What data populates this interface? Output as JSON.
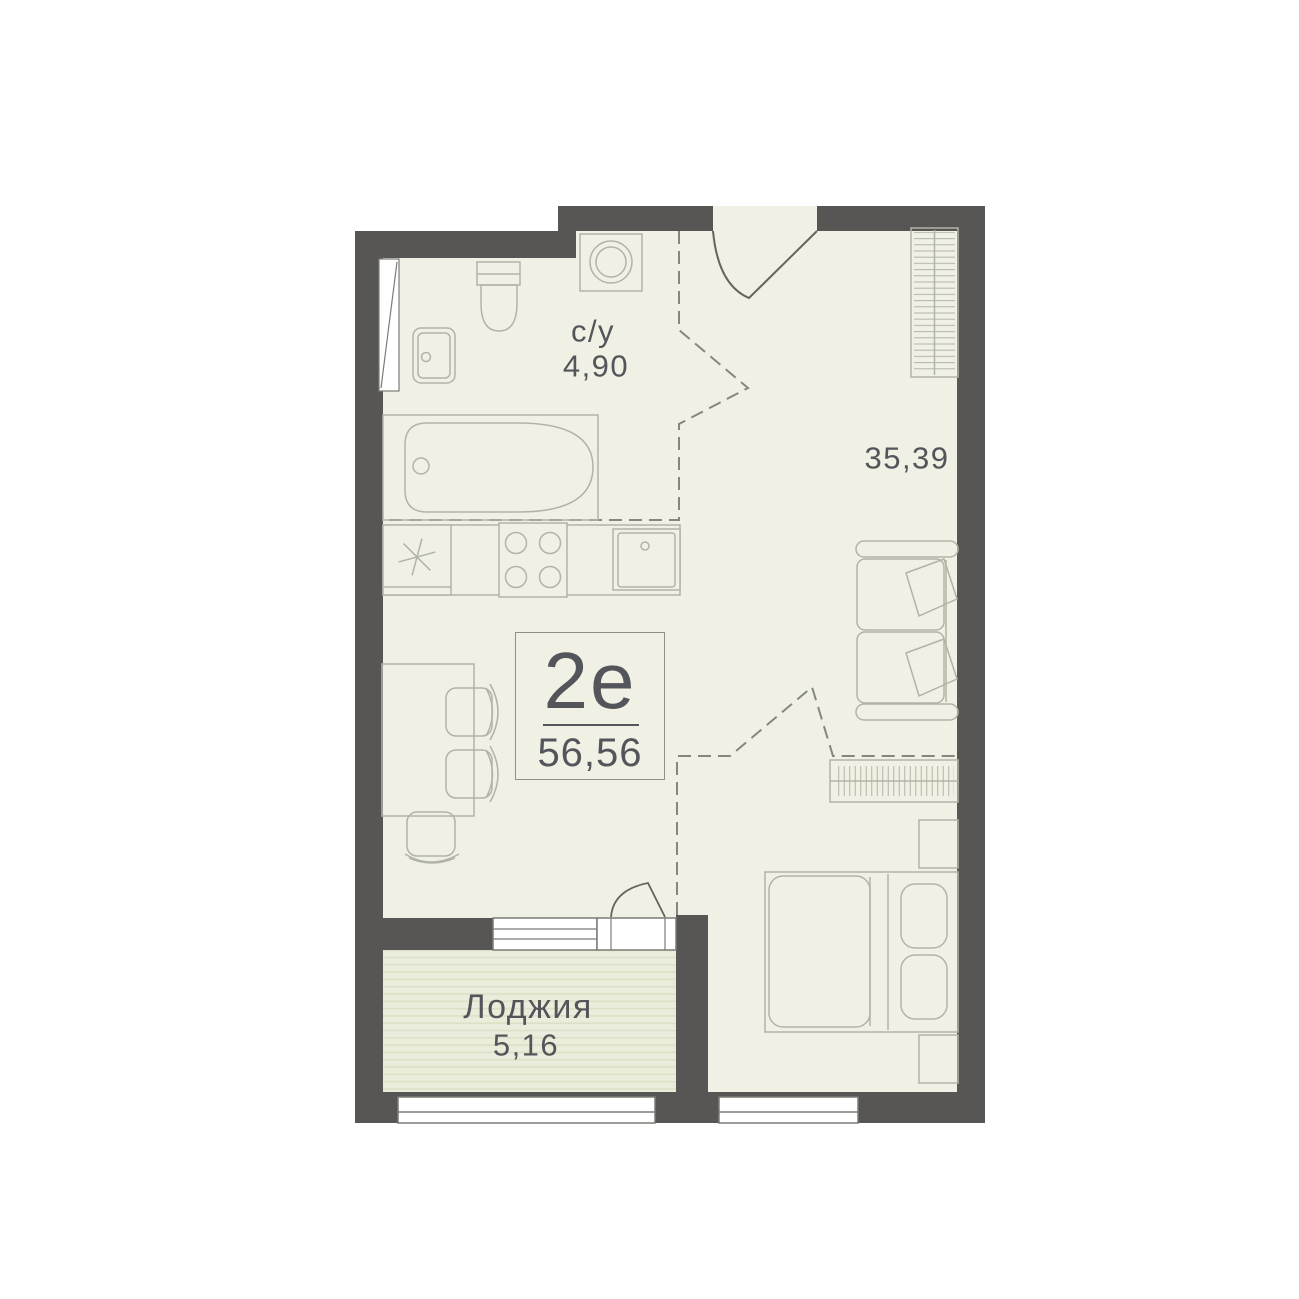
{
  "unit": {
    "layout_type": "2е",
    "total_area": "56,56"
  },
  "rooms": {
    "bathroom": {
      "label": "с/у",
      "area": "4,90"
    },
    "living_room": {
      "area": "35,39"
    },
    "loggia": {
      "label": "Лоджия",
      "area": "5,16"
    }
  },
  "colors": {
    "wall": "#575654",
    "floor": "#f0f1e4",
    "loggia_floor": "#eaeddb",
    "loggia_stripe": "#dbe0c6",
    "furniture_line": "#b2b3a7",
    "frame_line": "#7b7c75",
    "door_line": "#63645e",
    "zone_dash": "#85867f",
    "text": "#54555a",
    "background": "#ffffff"
  }
}
